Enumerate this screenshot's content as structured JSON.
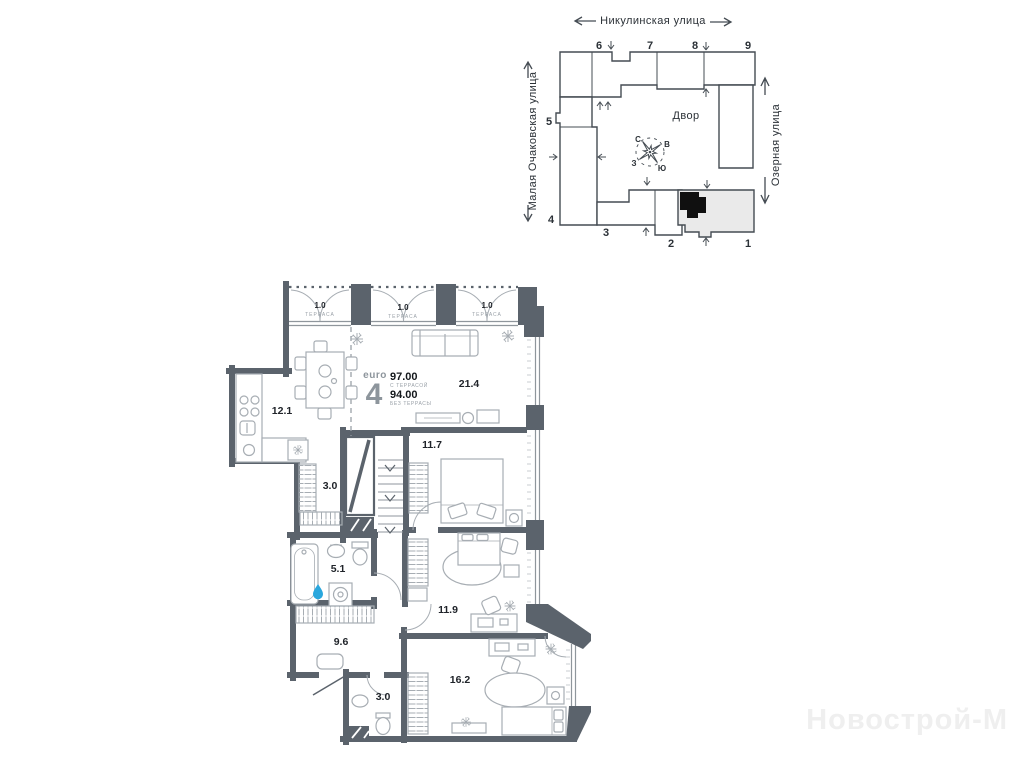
{
  "site_plan": {
    "street_top": "Никулинская улица",
    "street_left": "Малая Очаковская улица",
    "street_right": "Озерная улица",
    "courtyard_label": "Двор",
    "compass": {
      "north": "С",
      "east": "В",
      "south": "Ю",
      "west": "З"
    },
    "building_numbers": {
      "n1": "1",
      "n2": "2",
      "n3": "3",
      "n4": "4",
      "n5": "5",
      "n6": "6",
      "n7": "7",
      "n8": "8",
      "n9": "9"
    }
  },
  "unit": {
    "type_label": "euro",
    "rooms_count": "4",
    "area_with_terrace": "97.00",
    "with_terrace_label": "С ТЕРРАСОЙ",
    "area_without_terrace": "94.00",
    "without_terrace_label": "БЕЗ ТЕРРАСЫ"
  },
  "rooms": {
    "kitchen_dining_area": "12.1",
    "living_area": "21.4",
    "bedroom1_area": "11.7",
    "hall_small_area": "3.0",
    "bathroom_area": "5.1",
    "hallway_area": "9.6",
    "bedroom2_area": "11.9",
    "wc_area": "3.0",
    "bedroom3_area": "16.2",
    "terraces": [
      {
        "area": "1.0",
        "label": "ТЕРРАСА"
      },
      {
        "area": "1.0",
        "label": "ТЕРРАСА"
      },
      {
        "area": "1.0",
        "label": "ТЕРРАСА"
      }
    ]
  },
  "watermark": "Новострой-М",
  "colors": {
    "wall": "#5b636c",
    "furniture_line": "#a7adb3",
    "window_line": "#8f969c",
    "site_line": "#454c53",
    "highlight_building": "#eaeaea",
    "unit_marker": "#101010",
    "water_drop": "#2aa7dd"
  }
}
